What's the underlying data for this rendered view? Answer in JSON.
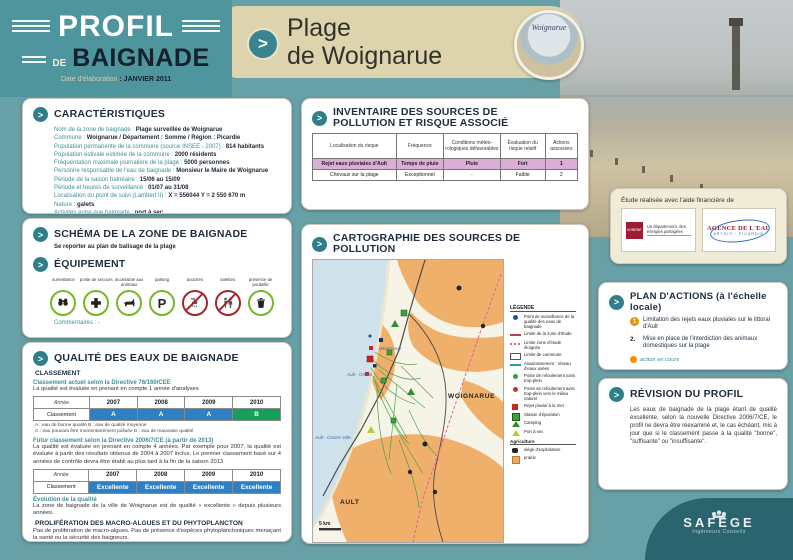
{
  "header": {
    "logo_line1": "PROFIL",
    "logo_de": "DE",
    "logo_line2": "BAIGNADE",
    "date_label": "Date d'élaboration",
    "date_value": ": JANVIER 2011",
    "title_line1": "Plage",
    "title_line2": "de Woignarue",
    "badge_caption": "Woignarue"
  },
  "caracteristiques": {
    "title": "CARACTÉRISTIQUES",
    "lines": [
      {
        "label": "Nom de la zone de baignade :",
        "value": "Plage surveillée de Woignarue"
      },
      {
        "label": "Commune :",
        "value": "Woignarue  /  Département : Somme  /  Région : Picardie"
      },
      {
        "label": "Population permanente de la commune (source INSEE - 2007) :",
        "value": "814 habitants"
      },
      {
        "label": "Population estivale estimée de la commune :",
        "value": "2000 résidents"
      },
      {
        "label": "Fréquentation maximale journalière de la plage :",
        "value": "5000 personnes"
      },
      {
        "label": "Personne responsable de l'eau de baignade :",
        "value": "Monsieur le Maire de Woignarue"
      },
      {
        "label": "Période de la saison balnéaire :",
        "value": "15/06 au 15/09"
      },
      {
        "label": "Période et heures de surveillance :",
        "value": "01/07 au 31/08"
      },
      {
        "label": "Localisation du point de suivi (Lambert II) :",
        "value": "X = 556044    Y = 2 550 670 m"
      },
      {
        "label": "Nature :",
        "value": "galets"
      },
      {
        "label": "Activités autre que baignade :",
        "value": "port à sec"
      }
    ]
  },
  "schema": {
    "title": "SCHÉMA DE LA ZONE DE BAIGNADE",
    "note": "Se reporter au plan de balisage de la plage"
  },
  "equipement": {
    "title": "ÉQUIPEMENT",
    "comments": "Commentaires : -",
    "items": [
      {
        "label": "surveillance",
        "status": "allowed",
        "icon": "binoculars-icon"
      },
      {
        "label": "poste de secours",
        "status": "allowed",
        "icon": "first-aid-cross-icon"
      },
      {
        "label": "accessible aux animaux",
        "status": "allowed",
        "icon": "dog-icon"
      },
      {
        "label": "parking",
        "status": "allowed",
        "icon": "parking-icon",
        "glyph": "P"
      },
      {
        "label": "douches",
        "status": "forbidden",
        "icon": "shower-icon"
      },
      {
        "label": "toilettes",
        "status": "forbidden",
        "icon": "toilets-icon"
      },
      {
        "label": "présence de poubelle",
        "status": "allowed",
        "icon": "trash-bin-icon"
      }
    ]
  },
  "qualite": {
    "title": "QUALITÉ DES EAUX DE BAIGNADE",
    "classement_heading": "CLASSEMENT",
    "current_heading": "Classement actuel selon la Directive 76/160/CEE",
    "current_note": "La qualité est évaluée en prenant en compte 1 année d'analyses",
    "table1": {
      "col0": "Année",
      "years": [
        "2007",
        "2008",
        "2009",
        "2010"
      ],
      "row_label": "Classement",
      "values": [
        "A",
        "A",
        "A",
        "B"
      ],
      "value_classes": [
        "blue",
        "blue",
        "blue",
        "green"
      ]
    },
    "notes": [
      "A : eau de bonne qualité     B : eau de qualité moyenne",
      "C : eau pouvant être momentanément polluée     D : eau de mauvaise qualité"
    ],
    "future_heading": "Futur classement selon la Directive 2006/7/CE (à partir de 2013)",
    "future_text": "La qualité est évaluée en prenant en compte 4 années. Par exemple pour 2007, la qualité est évaluée à partir des résultats obtenus de 2004 à 2007 inclus. Le premier classement basé sur 4 années de contrôle devra être établi au plus tard à la fin de la saison 2013.",
    "table2": {
      "col0": "Année",
      "years": [
        "2007",
        "2008",
        "2009",
        "2010"
      ],
      "row_label": "Classement",
      "values": [
        "Excellente",
        "Excellente",
        "Excellente",
        "Excellente"
      ],
      "value_classes": [
        "blue",
        "blue",
        "blue",
        "blue"
      ]
    },
    "evolution_heading": "Évolution de la qualité",
    "evolution_text": "La zone de baignade de la ville de Woignarue est de qualité « excellente » depuis plusieurs années.",
    "prolif_heading": "PROLIFÉRATION DES MACRO-ALGUES ET DU PHYTOPLANCTON",
    "prolif_text": "Pas de prolifération de macro-algues. Pas de présence d'espèces phytoplanctoniques menaçant la santé ou la sécurité des baigneurs."
  },
  "inventaire": {
    "title": "INVENTAIRE DES SOURCES DE POLLUTION ET RISQUE ASSOCIÉ",
    "headers": [
      "Localisation du risque",
      "Fréquence",
      "Conditions météo- rologiques défavorables",
      "Évaluation du risque relatif",
      "Actions associées"
    ],
    "rows": [
      {
        "row_class": "pink",
        "cells": [
          "Rejet eaux pluviales d'Ault",
          "Temps de pluie",
          "Pluie",
          "Fort",
          "1"
        ]
      },
      {
        "row_class": "",
        "cells": [
          "Chevaux sur la plage",
          "Exceptionnel",
          "-",
          "Faible",
          "2"
        ]
      }
    ]
  },
  "cartographie": {
    "title": "CARTOGRAPHIE DES SOURCES DE POLLUTION",
    "legend_title": "LÉGENDE",
    "legend": [
      {
        "sym": "dot-blue",
        "label": "Point de surveillance de la qualité des eaux de baignade"
      },
      {
        "sym": "line-red",
        "label": "Limite de la zone d'étude"
      },
      {
        "sym": "line-pink",
        "label": "Limite zone d'étude éloignée"
      },
      {
        "sym": "rect-white",
        "label": "Limite de commune"
      },
      {
        "sym": "line-teal",
        "label": "Assainissement : réseau d'eaux usées"
      },
      {
        "sym": "dot-green",
        "label": "Poste de refoulement sans trop-plein"
      },
      {
        "sym": "dot-red",
        "label": "Poste de refoulement avec trop-plein vers le milieu naturel"
      },
      {
        "sym": "sq-red",
        "label": "Rejet pluvial à la mer"
      },
      {
        "sym": "sq-green",
        "label": "Station d'épuration"
      },
      {
        "sym": "tri-green",
        "label": "Camping"
      },
      {
        "sym": "tri-yellow",
        "label": "Port à sec"
      }
    ],
    "agriculture_heading": "Agriculture",
    "legend_agri": [
      {
        "sym": "blob-black",
        "label": "siège d'exploitation"
      },
      {
        "sym": "sq-orange",
        "label": "prairie"
      }
    ],
    "map_labels": {
      "town1": "Woignarue",
      "town2": "Ault - Onival",
      "commune1": "WOIGNARUE",
      "town3": "Ault - Centre-Ville",
      "commune2": "AULT",
      "scale": "5 km"
    }
  },
  "funding": {
    "title": "Étude réalisée avec l'aide financière de",
    "logo1_text": "somme",
    "logo1_tagline": "Un département, des énergies partagées",
    "logo2_text": "AGENCE DE L'EAU",
    "logo2_sub": "ARTOIS · PICARDIE"
  },
  "plan_actions": {
    "title": "PLAN D'ACTIONS (à l'échelle locale)",
    "items": [
      {
        "num": "1",
        "num_class": "num-orange",
        "text": "Limitation des rejets eaux pluviales sur le littoral d'Ault"
      },
      {
        "num": "2.",
        "num_class": "num-plain",
        "text": "Mise en place de l'interdiction des animaux domestiques sur la plage"
      }
    ],
    "note": "action en cours"
  },
  "revision": {
    "title": "RÉVISION DU PROFIL",
    "text": "Les eaux de baignade de la plage étant de qualité excellente, selon la nouvelle Directive 2006/7/CE, le profil ne devra être réexaminé et, le cas échéant, mis à jour que si le classement passe à la qualité \"bonne\", \"suffisante\" ou \"insuffisante\"."
  },
  "footer_logo": {
    "name": "SAFEGE",
    "tagline": "Ingénieurs Conseils"
  },
  "colors": {
    "accent_teal": "#2e7f8a",
    "navy": "#1e2d3d",
    "beige": "#ddd3ad",
    "blue_cell": "#2d80c4",
    "green_cell": "#14a05a",
    "pink_row": "#dcaed6",
    "orange": "#f29100"
  }
}
